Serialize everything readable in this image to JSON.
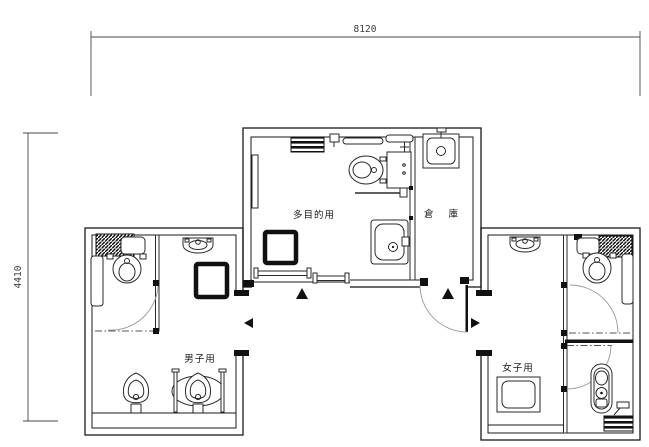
{
  "page": {
    "background": "#ffffff",
    "type": "architectural-floor-plan"
  },
  "dimensions": {
    "top": "8120",
    "left": "4410"
  },
  "rooms": {
    "multipurpose": {
      "label": "多目的用"
    },
    "storage": {
      "label": "倉 庫"
    },
    "mens": {
      "label": "男子用"
    },
    "womens": {
      "label": "女子用"
    }
  },
  "fixtures": [
    "accessible-toilet",
    "fold-down-bed",
    "baby-sheet-shelf",
    "grab-bar",
    "lavatory-counter",
    "floor-drain-box",
    "sliding-entrance-door",
    "mop-sink",
    "stall-toilet",
    "wall-hung-basin",
    "urinal",
    "urinal-with-grab-bars",
    "squat-toilet",
    "swing-door"
  ],
  "markers": [
    {
      "name": "multipurpose-entrance",
      "direction": "up"
    },
    {
      "name": "storage-entrance",
      "direction": "up"
    },
    {
      "name": "mens-entrance",
      "direction": "left"
    },
    {
      "name": "womens-entrance",
      "direction": "right"
    }
  ],
  "colors": {
    "line": "#1a1a1a",
    "door_arc": "#9a9a9a",
    "marker": "#111111",
    "background": "#ffffff"
  }
}
